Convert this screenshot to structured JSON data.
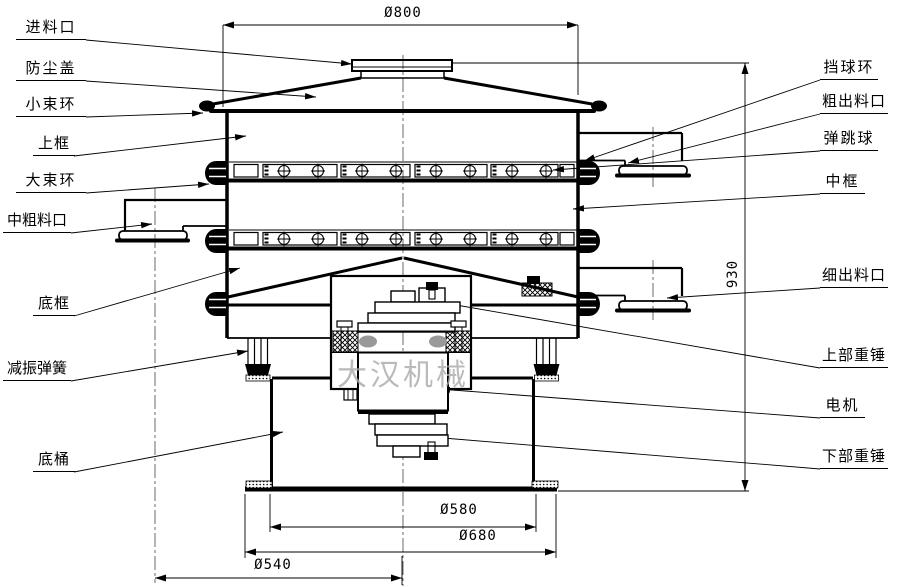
{
  "drawing": {
    "title_watermark": "大汉机械",
    "labels_left": [
      {
        "name": "feed-inlet",
        "text": "进料口"
      },
      {
        "name": "dust-cover",
        "text": "防尘盖"
      },
      {
        "name": "small-clamp-ring",
        "text": "小束环"
      },
      {
        "name": "upper-frame",
        "text": "上框"
      },
      {
        "name": "large-clamp-ring",
        "text": "大束环"
      },
      {
        "name": "mid-coarse-outlet",
        "text": "中粗料口"
      },
      {
        "name": "bottom-frame",
        "text": "底框"
      },
      {
        "name": "damping-spring",
        "text": "减振弹簧"
      },
      {
        "name": "bottom-barrel",
        "text": "底桶"
      }
    ],
    "labels_right": [
      {
        "name": "ball-stop-ring",
        "text": "挡球环"
      },
      {
        "name": "coarse-outlet",
        "text": "粗出料口"
      },
      {
        "name": "bouncing-ball",
        "text": "弹跳球"
      },
      {
        "name": "middle-frame",
        "text": "中框"
      },
      {
        "name": "fine-outlet",
        "text": "细出料口"
      },
      {
        "name": "upper-weight",
        "text": "上部重锤"
      },
      {
        "name": "motor",
        "text": "电机"
      },
      {
        "name": "lower-weight",
        "text": "下部重锤"
      }
    ],
    "dimensions": {
      "top_diameter": "Ø800",
      "mid_diameter": "Ø580",
      "base_diameter": "Ø680",
      "outlet_circle": "Ø540",
      "height": "930"
    },
    "line_color": "#000000",
    "watermark_color": "#a9a9a9"
  }
}
